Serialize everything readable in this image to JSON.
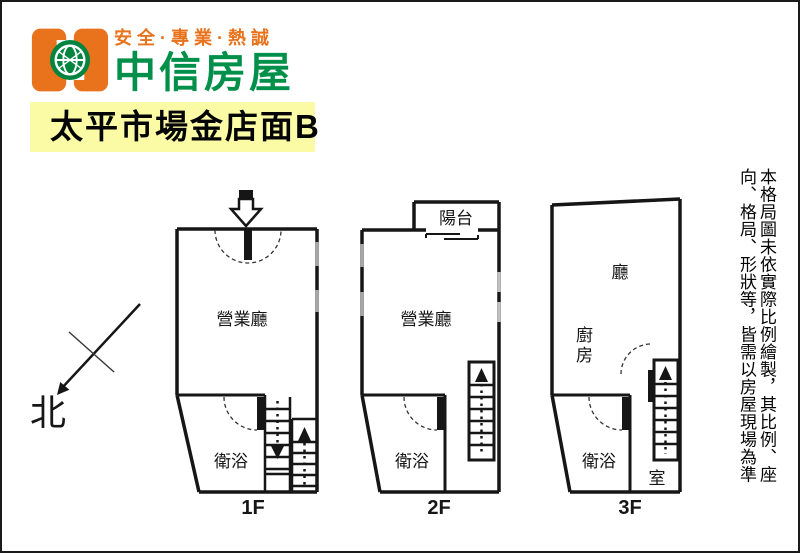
{
  "header": {
    "slogan": "安全·專業·熱誠",
    "brand": "中信房屋"
  },
  "banner": {
    "title": "太平市場金店面B"
  },
  "compass": {
    "north_label": "北"
  },
  "floors": [
    {
      "label": "1F",
      "main_room": "營業廳",
      "bathroom": "衛浴"
    },
    {
      "label": "2F",
      "main_room": "營業廳",
      "bathroom": "衛浴",
      "balcony": "陽台"
    },
    {
      "label": "3F",
      "hall": "廳",
      "kitchen": "廚房",
      "bathroom": "衛浴",
      "room": "室"
    }
  ],
  "disclaimer": "本格局圖未依實際比例繪製，其比例、座向、格局、形狀等，皆需以房屋現場為準",
  "icons": {
    "entrance": "hollow-down-arrow",
    "stairs_up": "solid-up-triangle",
    "stairs_down": "solid-down-triangle",
    "north": "diagonal-arrow-with-cross"
  },
  "colors": {
    "brand_orange": "#e8731c",
    "brand_green": "#009049",
    "banner_yellow": "#fbfba6",
    "wall_black": "#161616",
    "window_gray": "#a8a8a8"
  }
}
